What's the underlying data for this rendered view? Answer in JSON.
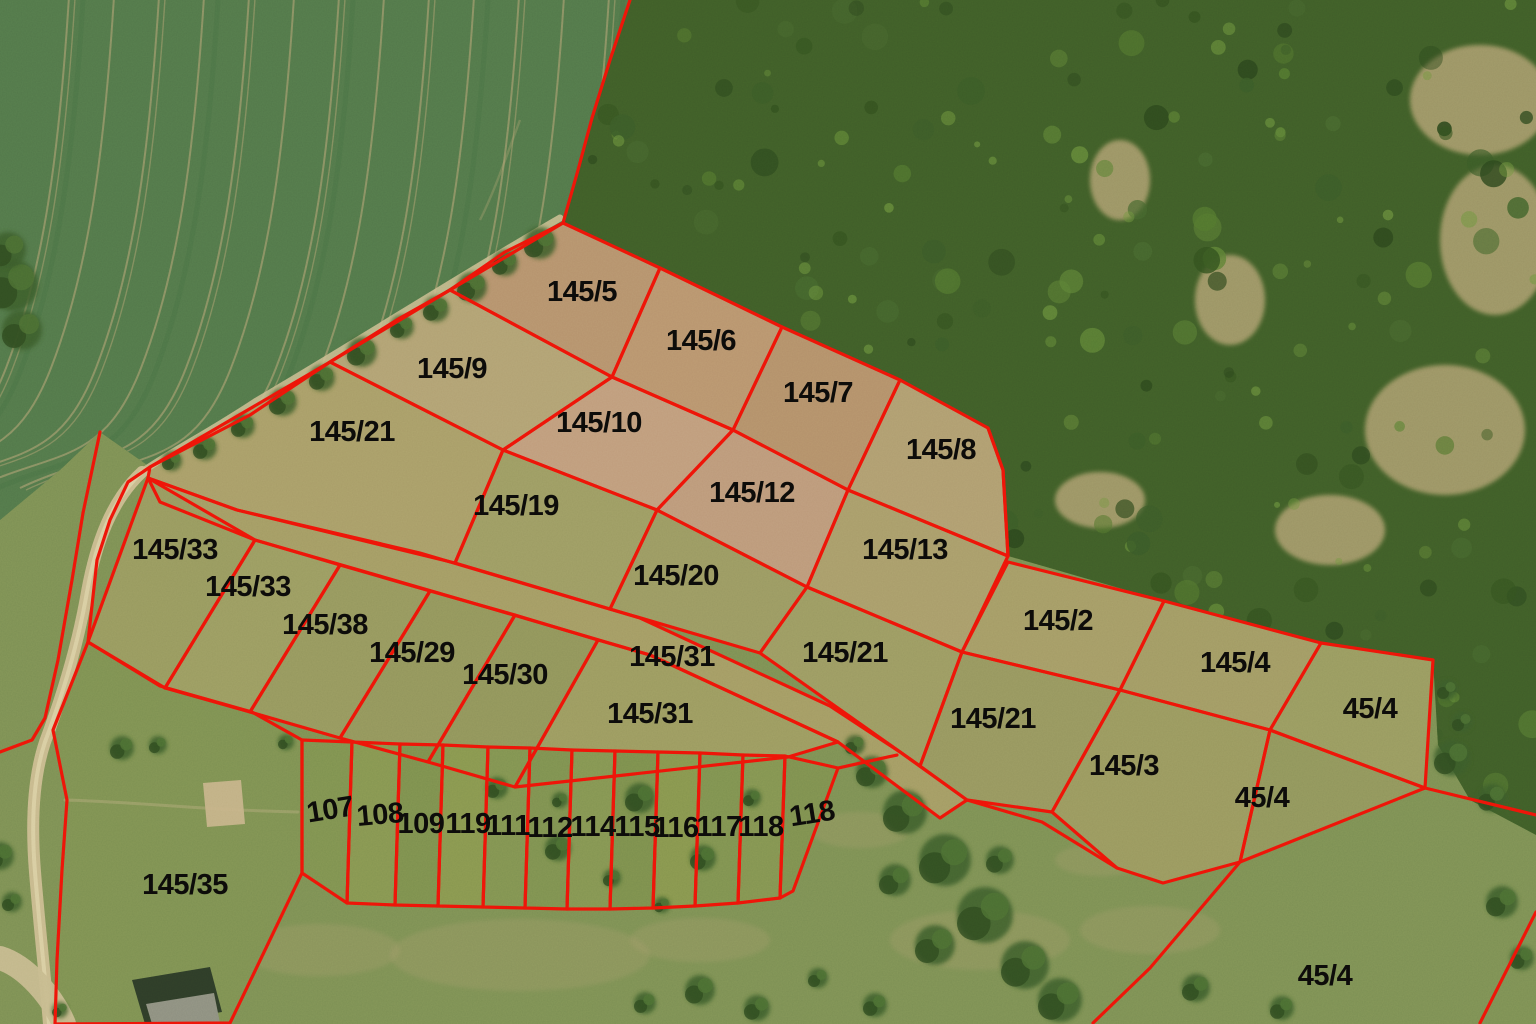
{
  "map": {
    "kind": "cadastral-parcel-overlay-on-orthophoto",
    "boundary_color": "#ee1408",
    "label_color": "#0d0c0a",
    "parcels": [
      {
        "id": "p145_5",
        "label": "145/5"
      },
      {
        "id": "p145_6",
        "label": "145/6"
      },
      {
        "id": "p145_7",
        "label": "145/7"
      },
      {
        "id": "p145_8",
        "label": "145/8"
      },
      {
        "id": "p145_9",
        "label": "145/9"
      },
      {
        "id": "p145_10",
        "label": "145/10"
      },
      {
        "id": "p145_12",
        "label": "145/12"
      },
      {
        "id": "p145_13",
        "label": "145/13"
      },
      {
        "id": "p145_21a",
        "label": "145/21"
      },
      {
        "id": "p145_19",
        "label": "145/19"
      },
      {
        "id": "p145_20",
        "label": "145/20"
      },
      {
        "id": "p145_21b",
        "label": "145/21"
      },
      {
        "id": "p145_2",
        "label": "145/2"
      },
      {
        "id": "p145_4",
        "label": "145/4"
      },
      {
        "id": "p45_4a",
        "label": "45/4"
      },
      {
        "id": "p145_31a",
        "label": "145/31"
      },
      {
        "id": "p145_31b",
        "label": "145/31"
      },
      {
        "id": "p145_21c",
        "label": "145/21"
      },
      {
        "id": "p145_3",
        "label": "145/3"
      },
      {
        "id": "p45_4b",
        "label": "45/4"
      },
      {
        "id": "p145_33a",
        "label": "145/33"
      },
      {
        "id": "p145_33b",
        "label": "145/33"
      },
      {
        "id": "p145_38",
        "label": "145/38"
      },
      {
        "id": "p145_29",
        "label": "145/29"
      },
      {
        "id": "p145_30",
        "label": "145/30"
      },
      {
        "id": "p145_35",
        "label": "145/35"
      },
      {
        "id": "p107",
        "label": "107"
      },
      {
        "id": "p108",
        "label": "108"
      },
      {
        "id": "p109",
        "label": "109"
      },
      {
        "id": "p119",
        "label": "119"
      },
      {
        "id": "p111",
        "label": "111"
      },
      {
        "id": "p112",
        "label": "112"
      },
      {
        "id": "p114",
        "label": "114"
      },
      {
        "id": "p115",
        "label": "115"
      },
      {
        "id": "p116",
        "label": "116"
      },
      {
        "id": "p117",
        "label": "117"
      },
      {
        "id": "p118a",
        "label": "118"
      },
      {
        "id": "p118b",
        "label": "118"
      },
      {
        "id": "p45_4c",
        "label": "45/4"
      }
    ]
  }
}
